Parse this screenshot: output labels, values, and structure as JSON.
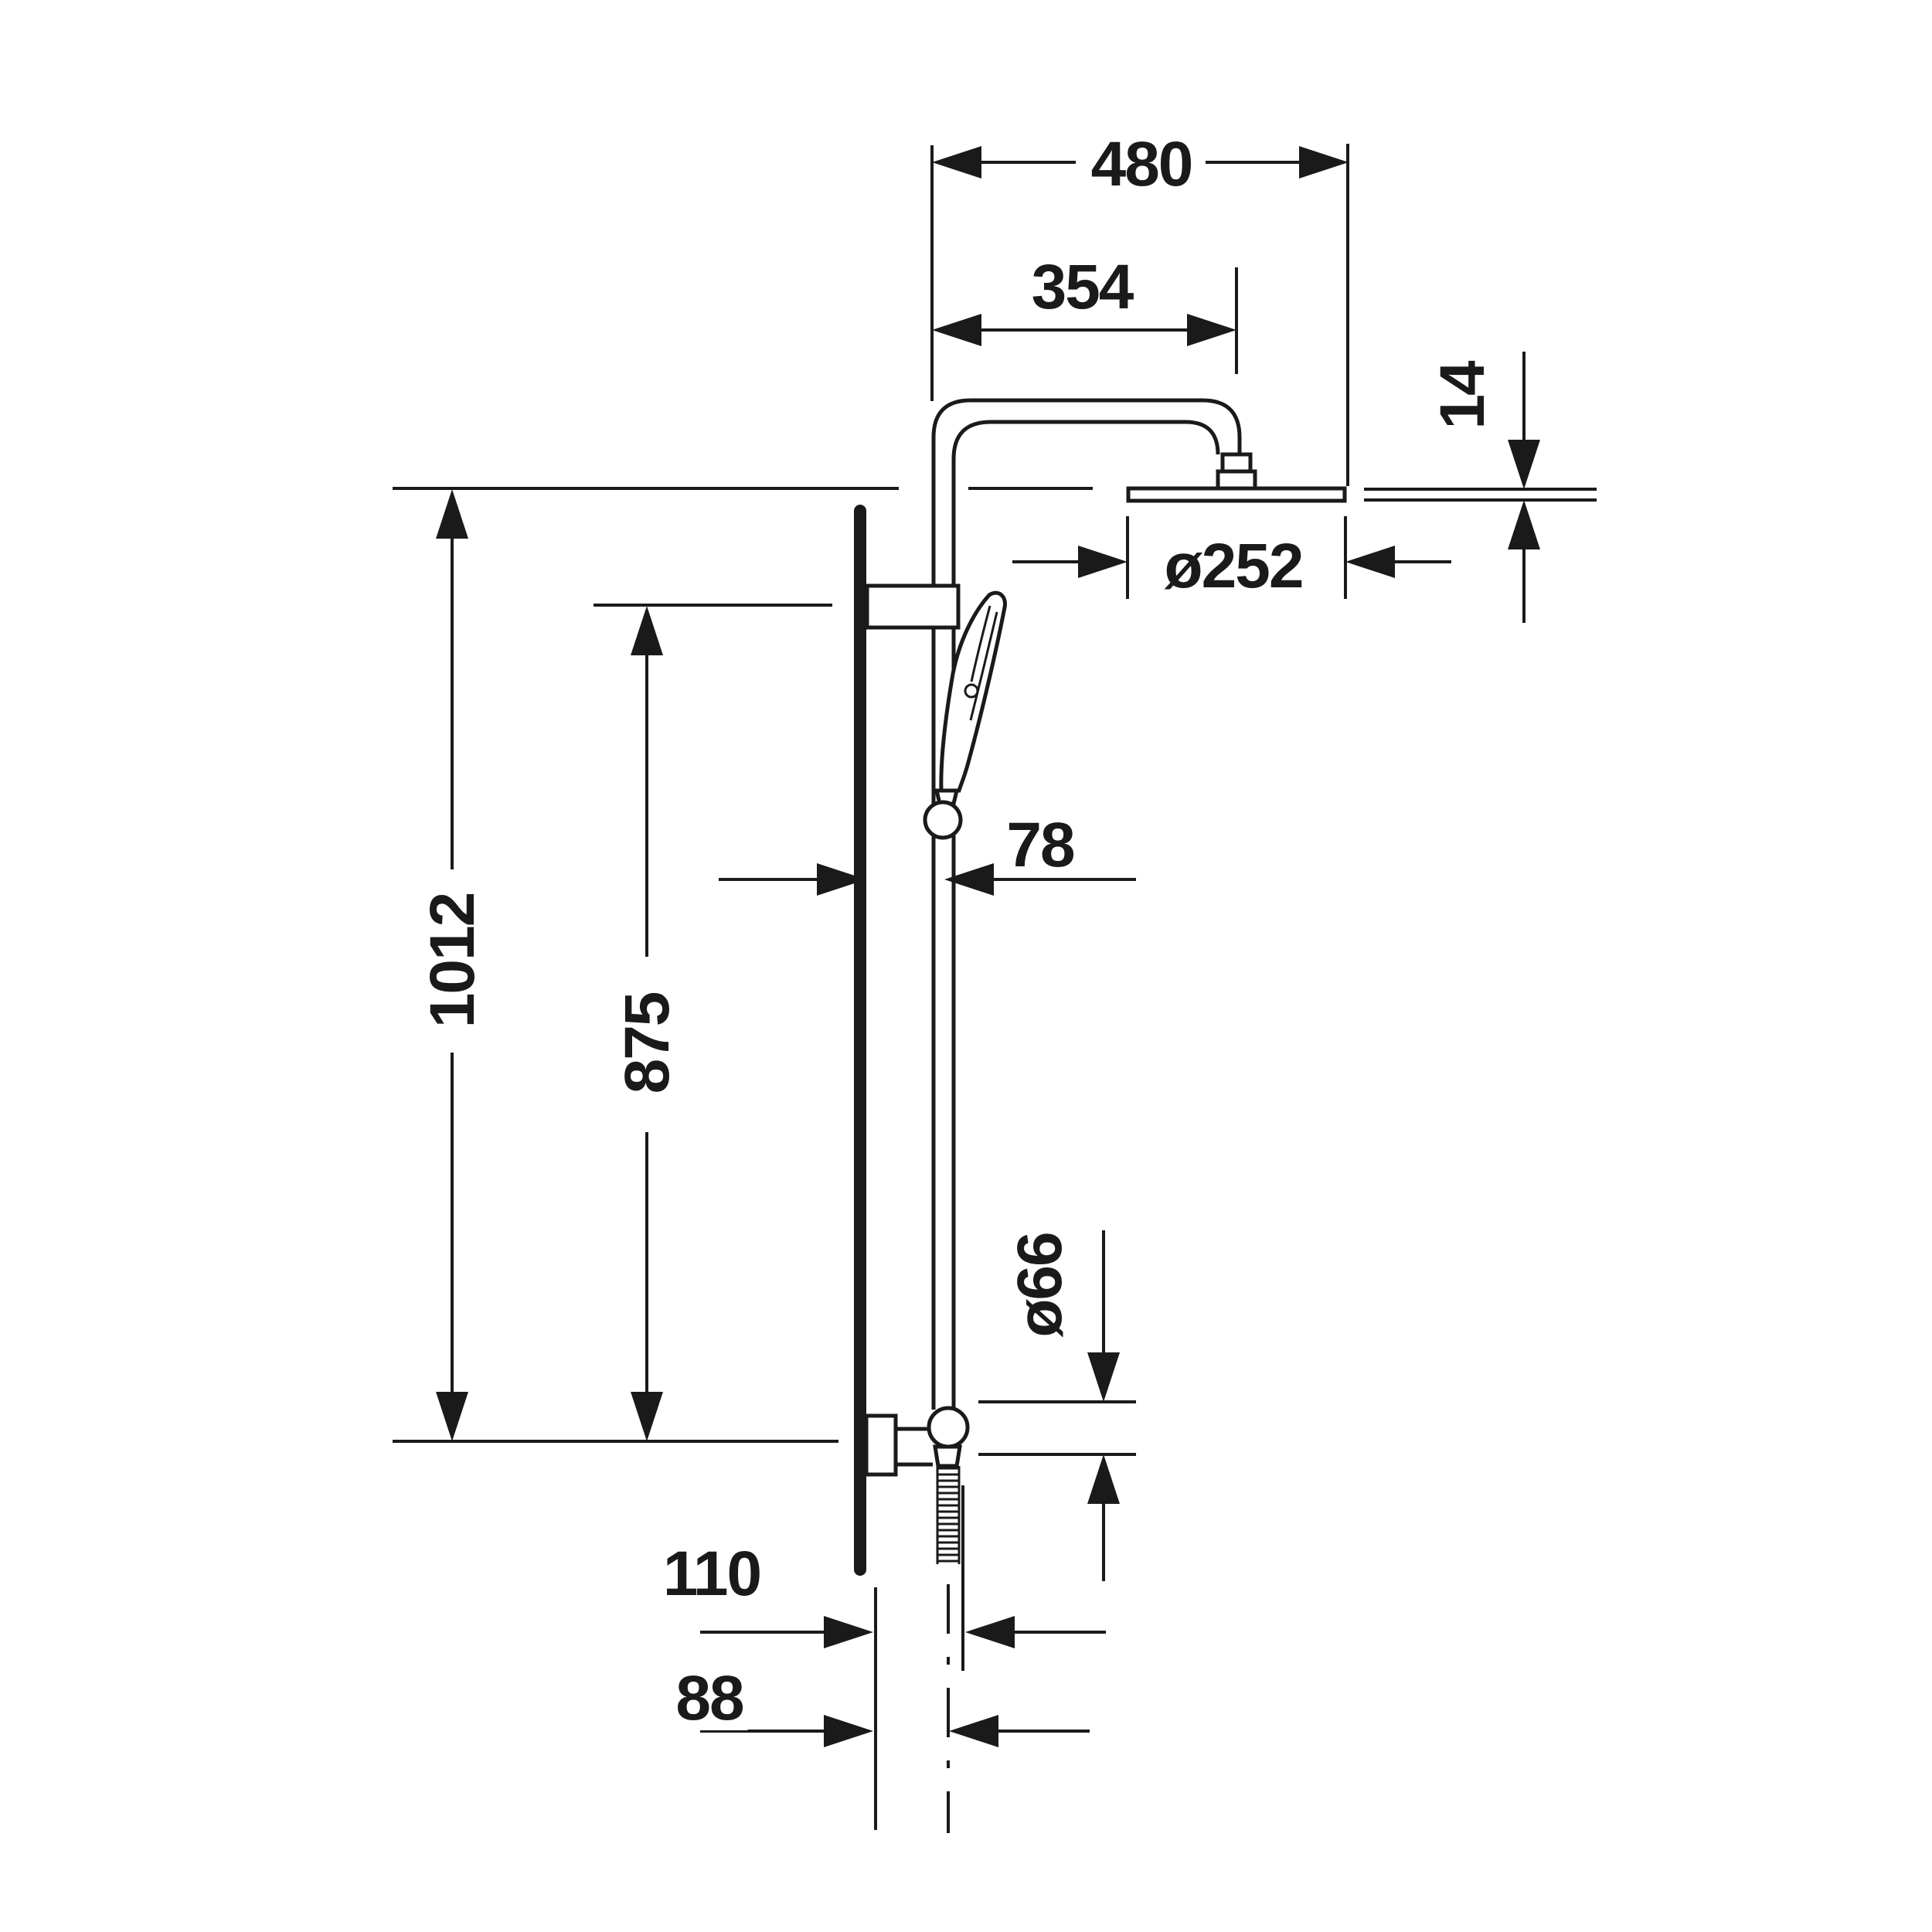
{
  "drawing": {
    "type": "technical-dimension-drawing",
    "subject": "shower-column-with-overhead-and-hand-shower",
    "unit": "mm",
    "colors": {
      "line": "#1a1a1a",
      "background": "#ffffff"
    },
    "labels": {
      "dim_480": {
        "text": "480"
      },
      "dim_354": {
        "text": "354"
      },
      "dim_14": {
        "text": "14"
      },
      "dim_252": {
        "text": "ø252"
      },
      "dim_78": {
        "text": "78"
      },
      "dim_1012": {
        "text": "1012"
      },
      "dim_875": {
        "text": "875"
      },
      "dim_66": {
        "text": "ø66"
      },
      "dim_110": {
        "text": "110"
      },
      "dim_88": {
        "text": "88"
      }
    }
  }
}
